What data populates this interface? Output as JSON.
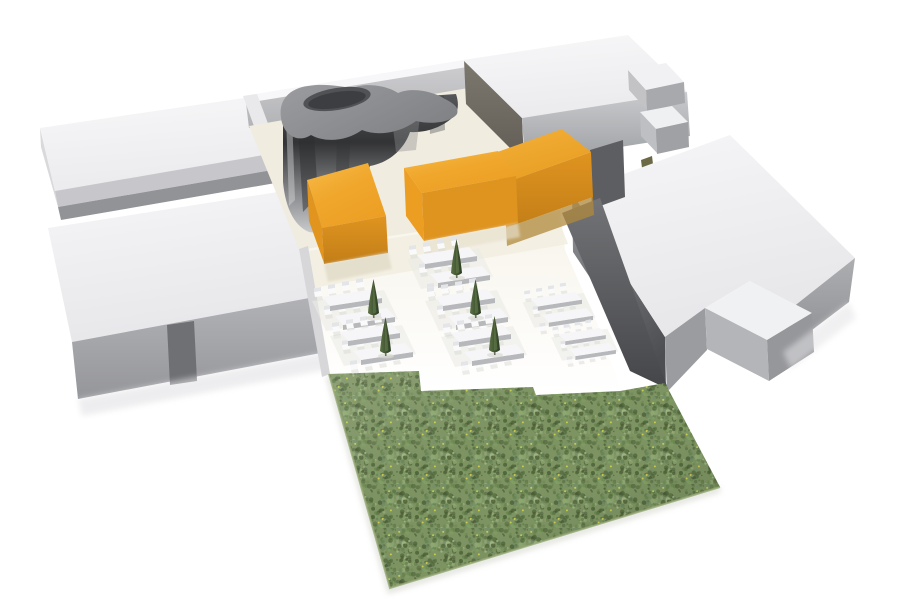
{
  "meta": {
    "canvas": {
      "width": 900,
      "height": 607
    },
    "background": "#ffffff",
    "scene_kind": "3d-architectural-massing-render"
  },
  "palette": {
    "white_roof": "#f2f2f4",
    "gray_face_light": "#c7c7cb",
    "gray_face_medium": "#9b9c9f",
    "gray_face_dark": "#55565a",
    "chrome_dark": "#323335",
    "blob_top_gray": "#8e8f92",
    "orange_top": "#f3ad33",
    "orange_face": "#e09420",
    "grass_green": "#7d9362",
    "cream_floor": "#f0ece0",
    "tree_green": "#3a4c2e"
  },
  "filters": [
    {
      "id": "f-blur1",
      "dev": 1.2
    },
    {
      "id": "f-blur3",
      "dev": 3
    }
  ],
  "gradients": [
    {
      "id": "g-roof",
      "x1": 0,
      "y1": 0,
      "x2": 0.25,
      "y2": 1,
      "stops": [
        [
          0,
          "#f8f8f9",
          1
        ],
        [
          1,
          "#ebebee",
          1
        ]
      ]
    },
    {
      "id": "g-roof-e",
      "x1": 0,
      "y1": 0,
      "x2": 0.3,
      "y2": 1,
      "stops": [
        [
          0,
          "#f6f6f8",
          1
        ],
        [
          1,
          "#e7e7ea",
          1
        ]
      ]
    },
    {
      "id": "g-face-light",
      "x1": 0,
      "y1": 0,
      "x2": 0,
      "y2": 1,
      "stops": [
        [
          0,
          "#cccccf",
          1
        ],
        [
          1,
          "#b2b3b6",
          1
        ]
      ]
    },
    {
      "id": "g-face-med",
      "x1": 0,
      "y1": 0,
      "x2": 0,
      "y2": 1,
      "stops": [
        [
          0,
          "#b3b4b7",
          1
        ],
        [
          1,
          "#95969a",
          1
        ]
      ]
    },
    {
      "id": "g-ne-front",
      "x1": 0,
      "y1": 0,
      "x2": 0,
      "y2": 1,
      "stops": [
        [
          0,
          "#c9cacd",
          1
        ],
        [
          1,
          "#9da0a3",
          1
        ]
      ]
    },
    {
      "id": "g-west-ne",
      "x1": 0,
      "y1": 0,
      "x2": 0,
      "y2": 1,
      "stops": [
        [
          0,
          "#7d786e",
          1
        ],
        [
          1,
          "#615d56",
          1
        ]
      ]
    },
    {
      "id": "g-facade-dark",
      "x1": 0.1,
      "y1": 0,
      "x2": 0.6,
      "y2": 1,
      "stops": [
        [
          0,
          "#8f9093",
          1
        ],
        [
          1,
          "#4d4e52",
          1
        ]
      ]
    },
    {
      "id": "g-gap-wall",
      "x1": 0,
      "y1": 0,
      "x2": 0,
      "y2": 1,
      "stops": [
        [
          0,
          "#727376",
          1
        ],
        [
          1,
          "#454649",
          1
        ]
      ]
    },
    {
      "id": "g-eblock-right",
      "x1": 0,
      "y1": 0,
      "x2": 0,
      "y2": 1,
      "stops": [
        [
          0,
          "#adaeb1",
          1
        ],
        [
          1,
          "#8d8e91",
          1
        ]
      ]
    },
    {
      "id": "g-chrome",
      "x1": 0,
      "y1": 0,
      "x2": 0,
      "y2": 1,
      "stops": [
        [
          0,
          "#57585b",
          1
        ],
        [
          0.35,
          "#323335",
          1
        ],
        [
          0.8,
          "#9b9c9f",
          1
        ],
        [
          1,
          "#c9cacc",
          1
        ]
      ]
    },
    {
      "id": "g-blob-top",
      "x1": 0,
      "y1": 0,
      "x2": 1,
      "y2": 0.6,
      "stops": [
        [
          0,
          "#9b9c9f",
          1
        ],
        [
          1,
          "#818285",
          1
        ]
      ]
    },
    {
      "id": "g-orange-top",
      "x1": 0,
      "y1": 0,
      "x2": 0.6,
      "y2": 1,
      "stops": [
        [
          0,
          "#f7bb4a",
          1
        ],
        [
          0.5,
          "#f0a72c",
          1
        ],
        [
          1,
          "#ec9f24",
          1
        ]
      ]
    },
    {
      "id": "g-orange-top2",
      "x1": 0,
      "y1": 0,
      "x2": 0.6,
      "y2": 1,
      "stops": [
        [
          0,
          "#f4b23c",
          1
        ],
        [
          1,
          "#e89d21",
          1
        ]
      ]
    },
    {
      "id": "g-orange-se",
      "x1": 0,
      "y1": 0,
      "x2": 0,
      "y2": 1,
      "stops": [
        [
          0,
          "#e09420",
          1
        ],
        [
          1,
          "#c27e17",
          1
        ]
      ]
    },
    {
      "id": "g-terrace",
      "x1": 0,
      "y1": 0,
      "x2": 0,
      "y2": 1,
      "stops": [
        [
          0,
          "#f7f4ea",
          1
        ],
        [
          1,
          "#ffffff",
          1
        ]
      ]
    },
    {
      "id": "g-tree",
      "x1": 0,
      "y1": 0,
      "x2": 1,
      "y2": 0,
      "stops": [
        [
          0,
          "#5c7245",
          1
        ],
        [
          1,
          "#2c3c23",
          1
        ]
      ]
    },
    {
      "id": "g-grass-ov",
      "x1": 0,
      "y1": 0,
      "x2": 1,
      "y2": 1,
      "stops": [
        [
          0,
          "#ffffff",
          0.12
        ],
        [
          0.35,
          "#ffffff",
          0
        ],
        [
          0.6,
          "#172112",
          0
        ],
        [
          1,
          "#172112",
          0.2
        ]
      ]
    }
  ],
  "scene": {
    "shapes": [
      {
        "name": "slab-nw-west-face",
        "type": "polygon",
        "points": "40,128 55,191 58,207 41,147",
        "fill": "#d9d9dc"
      },
      {
        "name": "slab-nw-roof",
        "type": "polygon",
        "points": "40,128 298,90 310,147 55,191",
        "fill": "g-roof"
      },
      {
        "name": "slab-nw-front-face",
        "type": "polygon",
        "points": "55,191 310,147 313,163 58,207",
        "fill": "#c7c7cb"
      },
      {
        "name": "slab-nw-gap-face",
        "type": "polygon",
        "points": "58,207 313,163 316,176 61,220",
        "fill": "#929396"
      },
      {
        "name": "slab-sw-roof",
        "type": "polygon",
        "points": "48,228 335,183 352,290 72,342",
        "fill": "g-roof-e"
      },
      {
        "name": "slab-sw-front-face",
        "type": "polygon",
        "points": "72,342 352,290 358,346 78,399",
        "fill": "g-face-med"
      },
      {
        "name": "slab-sw-notch",
        "type": "polygon",
        "points": "167,325 194,321 197,381 170,385",
        "fill": "#6f7073"
      },
      {
        "name": "slab-sw-ground-shadow",
        "type": "polygon",
        "points": "78,399 358,346 362,363 82,416",
        "fill": "#e2e2e5",
        "opacity": 0.6,
        "filter": "f-blur3"
      },
      {
        "name": "courtyard-north-parapet",
        "type": "polygon",
        "points": "243,96 464,60 467,67 246,103",
        "fill": "#f7f7f9"
      },
      {
        "name": "courtyard-north-wall",
        "type": "polygon",
        "points": "246,103 467,67 470,92 249,128",
        "fill": "g-face-light"
      },
      {
        "name": "courtyard-west-parapet",
        "type": "polygon",
        "points": "243,96 257,94 313,244 299,250",
        "fill": "#e9e9eb"
      },
      {
        "name": "courtyard-floor",
        "type": "polygon",
        "points": "249,126 468,88 543,158 540,192 468,238 318,252 299,249",
        "fill": "#f0ece0"
      },
      {
        "name": "blob-pavilion-wall",
        "type": "path",
        "d": "M 283,106 L 456,94 C 459,103 459,112 452,118 C 441,128 424,133 410,132 C 404,150 388,163 370,166 C 364,186 352,206 338,220 C 328,231 314,236 305,230 C 292,222 285,204 283,182 Z",
        "fill": "g-chrome"
      },
      {
        "name": "blob-wall-streak-1",
        "type": "polygon",
        "points": "297,108 312,106 318,196 303,212",
        "fill": "#2c2d2f",
        "opacity": 0.5
      },
      {
        "name": "blob-wall-streak-2",
        "type": "polygon",
        "points": "338,104 352,102 349,168 336,173",
        "fill": "#323335",
        "opacity": 0.35
      },
      {
        "name": "blob-wall-streak-3",
        "type": "polygon",
        "points": "428,98 444,96 445,130 430,134",
        "fill": "#3a3b3e",
        "opacity": 0.35
      },
      {
        "name": "blob-wall-highlight",
        "type": "polygon",
        "points": "286,115 292,114 295,200 289,206",
        "fill": "#d5d6d8",
        "opacity": 0.45
      },
      {
        "name": "blob-wall-sheen",
        "type": "polygon",
        "points": "392,120 420,116 416,150 396,152",
        "fill": "#8e8f92",
        "opacity": 0.4
      },
      {
        "name": "blob-pavilion-top",
        "type": "path",
        "d": "M 281,118 C 278,99 291,88 308,86 C 326,83 341,87 353,88 C 366,82 388,86 398,93 C 411,87 433,91 445,99 C 455,104 459,108 457,114 C 451,122 433,125 416,121 C 401,132 380,137 362,130 C 347,141 325,143 311,135 C 297,144 283,134 281,118 Z",
        "fill": "g-blob-top"
      },
      {
        "name": "blob-roof-hole-rim",
        "type": "ellipse",
        "cx": 337,
        "cy": 99,
        "rx": 34,
        "ry": 11,
        "transform": "rotate(-9 337 99)",
        "fill": "#515255"
      },
      {
        "name": "blob-roof-hole",
        "type": "ellipse",
        "cx": 337,
        "cy": 100,
        "rx": 29,
        "ry": 8,
        "transform": "rotate(-9 337 100)",
        "fill": "#3d3e41"
      },
      {
        "name": "ne-block-west-face",
        "type": "polygon",
        "points": "464,60 522,118 524,162 466,104",
        "fill": "g-west-ne"
      },
      {
        "name": "ne-block-roof",
        "type": "polygon",
        "points": "463,60 628,35 687,92 522,118",
        "fill": "g-roof"
      },
      {
        "name": "ne-block-front-face",
        "type": "polygon",
        "points": "522,118 687,92 690,136 525,162",
        "fill": "g-ne-front"
      },
      {
        "name": "small-cube-a-west-face",
        "type": "polygon",
        "points": "628,70 646,90 647,110 629,90",
        "fill": "#c3c3c6"
      },
      {
        "name": "small-cube-a-roof",
        "type": "polygon",
        "points": "628,70 666,63 684,82 646,90",
        "fill": "#f1f1f3"
      },
      {
        "name": "small-cube-a-front-face",
        "type": "polygon",
        "points": "646,90 684,82 685,103 647,111",
        "fill": "#a8a9ac"
      },
      {
        "name": "small-cube-b-west-face",
        "type": "polygon",
        "points": "640,112 656,129 657,153 641,136",
        "fill": "#bebfc2"
      },
      {
        "name": "small-cube-b-roof",
        "type": "polygon",
        "points": "640,112 672,106 688,122 656,129",
        "fill": "#eff0f2"
      },
      {
        "name": "small-cube-b-front-face",
        "type": "polygon",
        "points": "656,129 688,122 689,147 657,154",
        "fill": "#a0a1a4"
      },
      {
        "name": "shrub-detail",
        "type": "polygon",
        "points": "641,160 652,156 654,172 643,176",
        "fill": "#6c6947"
      },
      {
        "name": "east-block-sw-facade",
        "type": "polygon",
        "points": "572,193 665,337 666,392 573,252",
        "fill": "g-facade-dark"
      },
      {
        "name": "east-block-roof",
        "type": "polygon",
        "points": "730,135 855,258 788,311 750,281 705,308 665,337 572,193",
        "fill": "g-roof-e"
      },
      {
        "name": "east-block-right-face",
        "type": "polygon",
        "points": "855,258 788,311 783,352 849,302",
        "fill": "g-eblock-right"
      },
      {
        "name": "east-block-south-face",
        "type": "polygon",
        "points": "665,337 705,308 707,350 667,392",
        "fill": "#9b9c9f"
      },
      {
        "name": "east-annex-roof",
        "type": "polygon",
        "points": "705,308 750,281 812,313 767,340",
        "fill": "#f0f1f3"
      },
      {
        "name": "east-annex-sw-face",
        "type": "polygon",
        "points": "705,308 767,340 769,381 707,349",
        "fill": "#b4b5b8"
      },
      {
        "name": "east-annex-se-face",
        "type": "polygon",
        "points": "767,340 812,313 814,352 769,381",
        "fill": "#96979a"
      },
      {
        "name": "east-block-ground-shadow",
        "type": "polygon",
        "points": "783,352 849,302 856,318 791,369",
        "fill": "#e4e4e7",
        "opacity": 0.55,
        "filter": "f-blur3"
      },
      {
        "name": "terrace-ground",
        "type": "polygon",
        "points": "299,250 560,210 565,250 600,330 620,388 536,393 421,391 419,372 329,374 310,300",
        "fill": "g-terrace"
      },
      {
        "name": "terrace-cream-band",
        "type": "polygon",
        "points": "302,252 556,213 568,244 312,288",
        "fill": "#f2eee1",
        "opacity": 0.9
      },
      {
        "name": "terrace-left-edge-shadow",
        "type": "polygon",
        "points": "299,249 308,246 330,374 322,377",
        "fill": "#d7d7da"
      },
      {
        "name": "gap-wall-upper",
        "type": "polygon",
        "points": "590,150 623,140 625,197 592,209",
        "fill": "#5d5e61"
      },
      {
        "name": "gap-wall-lower",
        "type": "polygon",
        "points": "562,213 600,198 668,389 630,371",
        "fill": "g-gap-wall"
      },
      {
        "name": "orange-cube-top",
        "type": "polygon",
        "points": "307,180 368,163 386,216 322,228",
        "fill": "g-orange-top"
      },
      {
        "name": "orange-cube-sw-face",
        "type": "polygon",
        "points": "307,180 322,228 324,263 309,221",
        "fill": "#e1951f"
      },
      {
        "name": "orange-cube-se-face",
        "type": "polygon",
        "points": "322,228 386,216 388,253 324,264",
        "fill": "g-orange-se"
      },
      {
        "name": "orange-cube-ground-shadow",
        "type": "polygon",
        "points": "324,264 388,252 392,269 328,282",
        "fill": "#ded7c3",
        "opacity": 0.7,
        "filter": "f-blur1"
      },
      {
        "name": "orange-bar-back-top",
        "type": "polygon",
        "points": "475,160 562,129 591,152 504,183",
        "fill": "g-orange-top2"
      },
      {
        "name": "orange-bar-back-se-face",
        "type": "polygon",
        "points": "504,183 591,152 593,197 506,228",
        "fill": "g-orange-se"
      },
      {
        "name": "orange-bar-back-base",
        "type": "polygon",
        "points": "506,228 593,197 594,215 507,246",
        "fill": "#b08a3c",
        "opacity": 0.75
      },
      {
        "name": "orange-bar-front-top",
        "type": "polygon",
        "points": "404,168 498,151 516,176 422,193",
        "fill": "g-orange-top"
      },
      {
        "name": "orange-bar-front-sw-face",
        "type": "polygon",
        "points": "404,168 422,193 424,241 406,216",
        "fill": "#ec9e23"
      },
      {
        "name": "orange-bar-front-se-face",
        "type": "polygon",
        "points": "422,193 516,176 518,223 424,241",
        "fill": "#e09420"
      },
      {
        "name": "orange-bar-ground-shadow",
        "type": "polygon",
        "points": "424,241 518,223 520,237 426,255",
        "fill": "#e7e0cd",
        "opacity": 0.65,
        "filter": "f-blur1"
      },
      {
        "name": "grass-lawn",
        "type": "grass"
      },
      {
        "name": "terrace-furniture",
        "type": "furniture"
      }
    ]
  },
  "grass": {
    "polygon": "329,374 419,371 421,391 533,387 536,395 620,391 665,383 720,487 390,588",
    "base": "#7d9362",
    "speckles": [
      "#5f7847",
      "#69854e",
      "#7fa062",
      "#8fa873",
      "#4e6339",
      "#a3b584",
      "#74906a"
    ],
    "dark_speckle": "#43552f",
    "fleck": "#d6d44f",
    "seed": 9,
    "tile": 44,
    "dot_count": 150,
    "dark_count": 40,
    "fleck_count": 5,
    "outer_shadow": {
      "d": "M 329,376 L 390,590 L 720,489",
      "stroke": "#c3c7ba",
      "width": 6,
      "opacity": 0.5,
      "filter": "f-blur3"
    },
    "edge": {
      "d": "M 329,374 L 390,588 L 720,487",
      "stroke": "#93a673",
      "width": 2,
      "opacity": 0.8
    }
  },
  "furniture": {
    "table_cluster_template": {
      "shadow": {
        "points": "-10,12 62,1 76,30 4,42",
        "fill": "#ebebe6",
        "opacity": 0.6
      },
      "tables": [
        {
          "top": "0,8 52,0 60,9 8,17",
          "front": "8,17 60,9 60,14 8,22"
        },
        {
          "top": "13,27 65,19 73,28 21,36",
          "front": "21,36 73,28 73,33 21,41"
        }
      ],
      "table_top_fill": "#f6f6f8",
      "table_front_fill": "#b7b8bb",
      "chair_offsets": [
        [
          -8,
          3
        ],
        [
          6,
          0
        ],
        [
          20,
          -3
        ],
        [
          34,
          -6
        ],
        [
          2,
          21
        ],
        [
          16,
          18
        ],
        [
          30,
          15
        ],
        [
          44,
          12
        ],
        [
          10,
          41
        ],
        [
          24,
          38
        ],
        [
          38,
          35
        ],
        [
          52,
          32
        ]
      ],
      "chair_seat": "0,0 7,-1 8,4 1,5",
      "chair_back": "0,-4 7,-5 7,-1 0,0",
      "chair_shadow": "1,5 8,4 9,8 2,9",
      "chair_seat_fill": "#fafafb",
      "chair_back_fill": "#e4e5e8",
      "chair_shadow_fill": "#d9d9d4",
      "chair_shadow_opacity": 0.5
    },
    "clusters": [
      {
        "x": 322,
        "y": 289,
        "scale": 1
      },
      {
        "x": 340,
        "y": 324,
        "scale": 1
      },
      {
        "x": 417,
        "y": 247,
        "scale": 1
      },
      {
        "x": 435,
        "y": 289,
        "scale": 1
      },
      {
        "x": 451,
        "y": 325,
        "scale": 1
      },
      {
        "x": 531,
        "y": 292,
        "scale": 0.85
      },
      {
        "x": 559,
        "y": 328,
        "scale": 0.78
      }
    ],
    "tree_template": {
      "cone_d": "M5.5,0 C7.5,10 10,22 11,34 C7,37 4,37 0,34 C1,22 3.5,10 5.5,0 Z",
      "cone_fill": "g-tree",
      "highlight_d": "M5.5,2 C6.3,12 7.6,24 8.4,33 C6.8,34.6 5.6,34.6 5,34 C4.9,22 5.1,10 5.5,2 Z",
      "highlight_fill": "#5e7547",
      "highlight_opacity": 0.7,
      "trunk": "4.8,34 6.4,34 6.6,39 5,39",
      "trunk_fill": "#6e6e5e",
      "shadow": {
        "cx": 6,
        "cy": 39,
        "rx": 8,
        "ry": 2.4,
        "fill": "#dcdcd2",
        "opacity": 0.7
      }
    },
    "trees": [
      {
        "x": 368,
        "y": 279
      },
      {
        "x": 380,
        "y": 317
      },
      {
        "x": 451,
        "y": 239
      },
      {
        "x": 470,
        "y": 279
      },
      {
        "x": 489,
        "y": 316
      }
    ]
  }
}
